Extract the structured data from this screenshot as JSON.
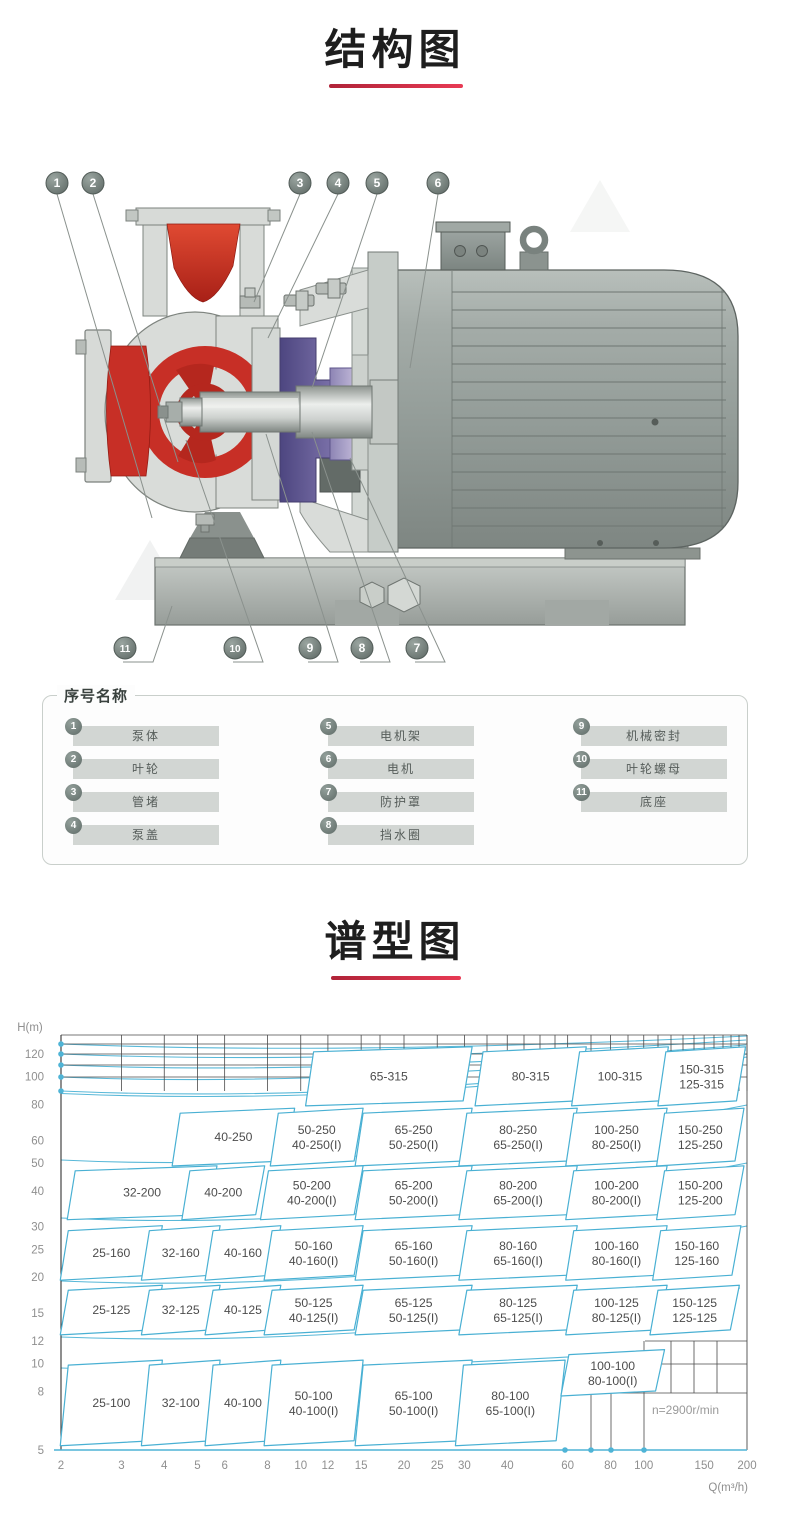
{
  "sections": {
    "structure": {
      "title": "结构图"
    },
    "spectrum": {
      "title": "谱型图"
    }
  },
  "legend": {
    "title": "序号名称",
    "items": [
      {
        "num": "1",
        "label": "泵体"
      },
      {
        "num": "2",
        "label": "叶轮"
      },
      {
        "num": "3",
        "label": "管堵"
      },
      {
        "num": "4",
        "label": "泵盖"
      },
      {
        "num": "5",
        "label": "电机架"
      },
      {
        "num": "6",
        "label": "电机"
      },
      {
        "num": "7",
        "label": "防护罩"
      },
      {
        "num": "8",
        "label": "挡水圈"
      },
      {
        "num": "9",
        "label": "机械密封"
      },
      {
        "num": "10",
        "label": "叶轮螺母"
      },
      {
        "num": "11",
        "label": "底座"
      }
    ]
  },
  "callouts": {
    "top": [
      "1",
      "2",
      "3",
      "4",
      "5",
      "6"
    ],
    "bottom": [
      "11",
      "10",
      "9",
      "8",
      "7"
    ]
  },
  "colors": {
    "accent_red": "#d8374e",
    "curve_cyan": "#4fb4d6",
    "pump_red": "#c72f26",
    "pump_purple": "#5d548b",
    "metal_gray": "#99a19d"
  },
  "chart_data": {
    "type": "area",
    "title": "谱型图",
    "xlabel": "Q(m³/h)",
    "ylabel": "H(m)",
    "scale": "log-log",
    "grid": true,
    "x_range": [
      2,
      200
    ],
    "y_range": [
      5,
      140
    ],
    "x_ticks": [
      2,
      3,
      4,
      5,
      6,
      8,
      10,
      12,
      15,
      20,
      25,
      30,
      40,
      60,
      80,
      100,
      150,
      200
    ],
    "y_ticks": [
      120,
      100,
      80,
      60,
      50,
      40,
      30,
      25,
      20,
      15,
      12,
      10,
      8,
      5
    ],
    "annotation": "n=2900r/min",
    "regions": [
      {
        "labels": [
          "65-315"
        ],
        "q": [
          10.9,
          31.6
        ],
        "h": [
          81,
          126
        ]
      },
      {
        "labels": [
          "80-315"
        ],
        "q": [
          34,
          68
        ],
        "h": [
          81,
          126
        ]
      },
      {
        "labels": [
          "100-315"
        ],
        "q": [
          65,
          118
        ],
        "h": [
          81,
          126
        ]
      },
      {
        "labels": [
          "150-315",
          "125-315"
        ],
        "q": [
          116,
          198
        ],
        "h": [
          81,
          126
        ]
      },
      {
        "labels": [
          "40-250"
        ],
        "q": [
          4.45,
          9.6
        ],
        "h": [
          50,
          77
        ]
      },
      {
        "labels": [
          "50-250",
          "40-250(I)"
        ],
        "q": [
          8.6,
          15.2
        ],
        "h": [
          50,
          77
        ]
      },
      {
        "labels": [
          "65-250",
          "50-250(I)"
        ],
        "q": [
          15.2,
          31.6
        ],
        "h": [
          50,
          77
        ]
      },
      {
        "labels": [
          "80-250",
          "65-250(I)"
        ],
        "q": [
          30.5,
          64
        ],
        "h": [
          50,
          77
        ]
      },
      {
        "labels": [
          "100-250",
          "80-250(I)"
        ],
        "q": [
          62.5,
          117
        ],
        "h": [
          50,
          77
        ]
      },
      {
        "labels": [
          "150-250",
          "125-250"
        ],
        "q": [
          115,
          196
        ],
        "h": [
          50,
          77
        ]
      },
      {
        "labels": [
          "32-200"
        ],
        "q": [
          2.2,
          5.7
        ],
        "h": [
          32.5,
          48.5
        ]
      },
      {
        "labels": [
          "40-200"
        ],
        "q": [
          4.75,
          7.85
        ],
        "h": [
          32.5,
          48.5
        ]
      },
      {
        "labels": [
          "50-200",
          "40-200(I)"
        ],
        "q": [
          8.05,
          15.2
        ],
        "h": [
          32.5,
          48.5
        ]
      },
      {
        "labels": [
          "65-200",
          "50-200(I)"
        ],
        "q": [
          15.2,
          31.6
        ],
        "h": [
          32.5,
          48.5
        ]
      },
      {
        "labels": [
          "80-200",
          "65-200(I)"
        ],
        "q": [
          30.5,
          64
        ],
        "h": [
          32.5,
          48.5
        ]
      },
      {
        "labels": [
          "100-200",
          "80-200(I)"
        ],
        "q": [
          62.5,
          117
        ],
        "h": [
          32.5,
          48.5
        ]
      },
      {
        "labels": [
          "150-200",
          "125-200"
        ],
        "q": [
          115,
          196
        ],
        "h": [
          32.5,
          48.5
        ]
      },
      {
        "labels": [
          "25-160"
        ],
        "q": [
          2.1,
          3.95
        ],
        "h": [
          20,
          30
        ]
      },
      {
        "labels": [
          "32-160"
        ],
        "q": [
          3.62,
          5.82
        ],
        "h": [
          20,
          30
        ]
      },
      {
        "labels": [
          "40-160"
        ],
        "q": [
          5.55,
          8.75
        ],
        "h": [
          20,
          30
        ]
      },
      {
        "labels": [
          "50-160",
          "40-160(I)"
        ],
        "q": [
          8.25,
          15.2
        ],
        "h": [
          20,
          30
        ]
      },
      {
        "labels": [
          "65-160",
          "50-160(I)"
        ],
        "q": [
          15.2,
          31.6
        ],
        "h": [
          20,
          30
        ]
      },
      {
        "labels": [
          "80-160",
          "65-160(I)"
        ],
        "q": [
          30.5,
          64
        ],
        "h": [
          20,
          30
        ]
      },
      {
        "labels": [
          "100-160",
          "80-160(I)"
        ],
        "q": [
          62.5,
          117
        ],
        "h": [
          20,
          30
        ]
      },
      {
        "labels": [
          "150-160",
          "125-160"
        ],
        "q": [
          112,
          192
        ],
        "h": [
          20,
          30
        ]
      },
      {
        "labels": [
          "25-125"
        ],
        "q": [
          2.1,
          3.95
        ],
        "h": [
          12.9,
          18.6
        ]
      },
      {
        "labels": [
          "32-125"
        ],
        "q": [
          3.62,
          5.82
        ],
        "h": [
          12.9,
          18.6
        ]
      },
      {
        "labels": [
          "40-125"
        ],
        "q": [
          5.55,
          8.75
        ],
        "h": [
          12.9,
          18.6
        ]
      },
      {
        "labels": [
          "50-125",
          "40-125(I)"
        ],
        "q": [
          8.25,
          15.2
        ],
        "h": [
          12.9,
          18.6
        ]
      },
      {
        "labels": [
          "65-125",
          "50-125(I)"
        ],
        "q": [
          15.2,
          31.6
        ],
        "h": [
          12.9,
          18.6
        ]
      },
      {
        "labels": [
          "80-125",
          "65-125(I)"
        ],
        "q": [
          30.5,
          64
        ],
        "h": [
          12.9,
          18.6
        ]
      },
      {
        "labels": [
          "100-125",
          "80-125(I)"
        ],
        "q": [
          62.5,
          117
        ],
        "h": [
          12.9,
          18.6
        ]
      },
      {
        "labels": [
          "150-125",
          "125-125"
        ],
        "q": [
          110,
          190
        ],
        "h": [
          12.9,
          18.6
        ]
      },
      {
        "labels": [
          "25-100"
        ],
        "q": [
          2.1,
          3.95
        ],
        "h": [
          5.3,
          10.2
        ]
      },
      {
        "labels": [
          "32-100"
        ],
        "q": [
          3.62,
          5.82
        ],
        "h": [
          5.3,
          10.2
        ]
      },
      {
        "labels": [
          "40-100"
        ],
        "q": [
          5.55,
          8.75
        ],
        "h": [
          5.3,
          10.2
        ]
      },
      {
        "labels": [
          "50-100",
          "40-100(I)"
        ],
        "q": [
          8.25,
          15.2
        ],
        "h": [
          5.3,
          10.2
        ]
      },
      {
        "labels": [
          "65-100",
          "50-100(I)"
        ],
        "q": [
          15.2,
          31.6
        ],
        "h": [
          5.3,
          10.2
        ]
      },
      {
        "labels": [
          "80-100",
          "65-100(I)"
        ],
        "q": [
          29.8,
          59
        ],
        "h": [
          5.3,
          10.2
        ]
      },
      {
        "labels": [
          "100-100",
          "80-100(I)"
        ],
        "q": [
          60.5,
          115
        ],
        "h": [
          7.9,
          11.1
        ]
      }
    ]
  }
}
